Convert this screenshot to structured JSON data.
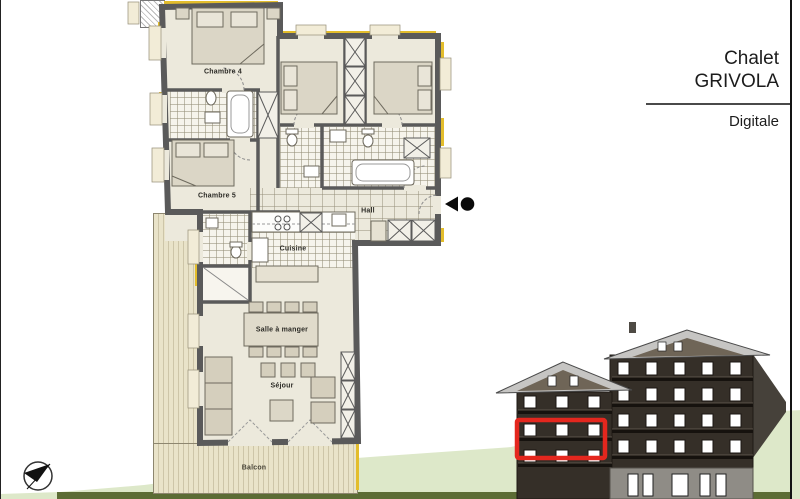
{
  "title_block": {
    "chalet": "Chalet",
    "name": "GRIVOLA",
    "unit": "Digitale"
  },
  "floor_plan": {
    "rooms": {
      "chambre4": "Chambre 4",
      "chambre5": "Chambre 5",
      "hall": "Hall",
      "cuisine": "Cuisine",
      "salle_a_manger": "Salle à manger",
      "sejour": "Séjour",
      "balcon": "Balcon"
    },
    "markers": {
      "entrance": "entrance-direction-marker",
      "north": "north-arrow"
    }
  },
  "elevation": {
    "highlight_color": "#e4271e"
  },
  "colors": {
    "wall": "#5a5a5a",
    "floor": "#ece9dc",
    "deck": "#e9e3c9",
    "insulation": "#e3bd2c",
    "ground": "#dde8c9",
    "ground_strip": "#5c6c35",
    "facade": "#352f28",
    "roof": "#c6c5c3",
    "highlight": "#e4271e"
  }
}
